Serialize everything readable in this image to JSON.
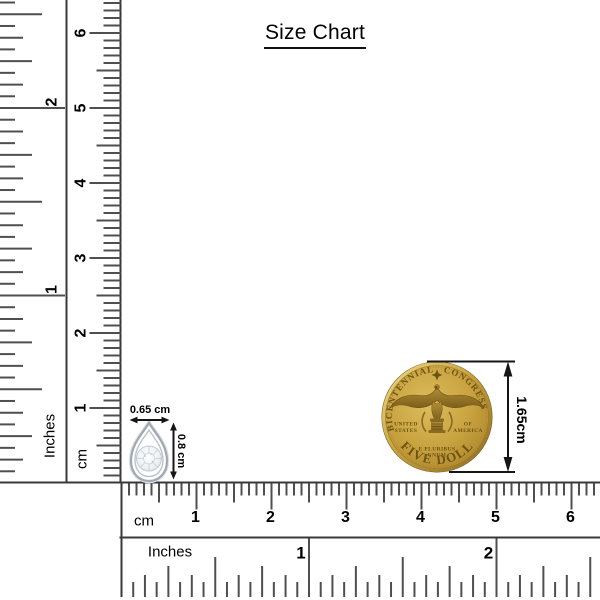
{
  "title": "Size Chart",
  "rulers": {
    "vertical_inch": {
      "unit_label": "Inches",
      "tick_numbers": [
        "1",
        "2"
      ]
    },
    "vertical_cm": {
      "unit_label": "cm",
      "tick_numbers": [
        "1",
        "2",
        "3",
        "4",
        "5",
        "6"
      ]
    },
    "horizontal_cm": {
      "unit_label": "cm",
      "tick_numbers": [
        "1",
        "2",
        "3",
        "4",
        "5",
        "6"
      ]
    },
    "horizontal_inch": {
      "unit_label": "Inches",
      "tick_numbers": [
        "1",
        "2"
      ]
    }
  },
  "pendant": {
    "description": "teardrop diamond pendant",
    "width_label": "0.65 cm",
    "height_label": "0.8 cm"
  },
  "coin": {
    "legend_top_left": "BICENTENNIAL",
    "legend_top_right": "CONGRESS",
    "left_line1": "UNITED",
    "left_line2": "STATES",
    "right_line1": "OF",
    "right_line2": "AMERICA",
    "motto_line1": "E PLURIBUS",
    "motto_line2": "UNUM",
    "denomination": "FIVE DOLLARS",
    "height_label": "1.65cm"
  },
  "colors": {
    "tick": "#4f4f4f",
    "coin_gold": "#c9a340",
    "coin_gold_dark": "#96731f",
    "coin_gold_light": "#ecd47f",
    "coin_lettering": "#6d5313",
    "pendant_silver": "#9fa8b0",
    "annotation": "#161616"
  }
}
